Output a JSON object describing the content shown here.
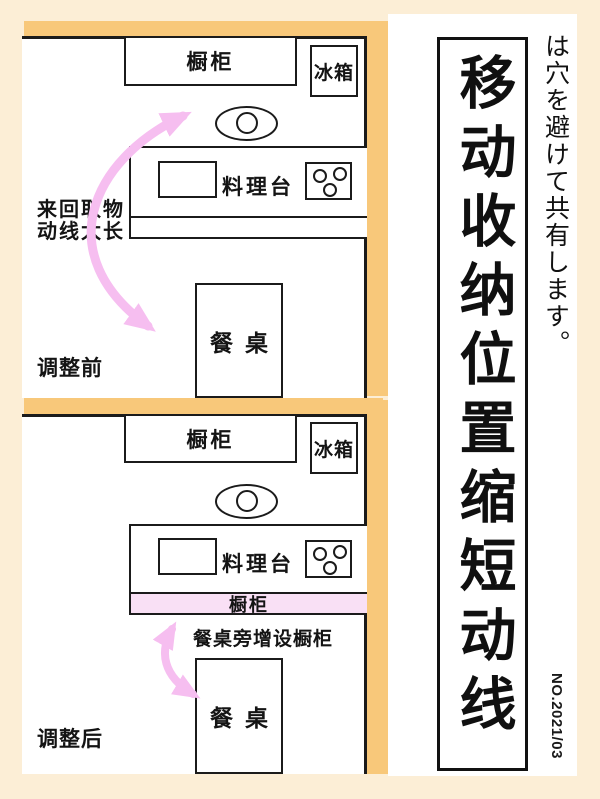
{
  "colors": {
    "background": "#FCEED6",
    "accent_orange": "#F8C87A",
    "arrow_pink": "#F6BEF0",
    "cupboard_pink": "#F9E0F5"
  },
  "before": {
    "section_label": "调整前",
    "flow_note_line1": "来回取物",
    "flow_note_line2": "动线太长",
    "cupboard_label": "橱柜",
    "fridge_label": "冰箱",
    "counter_label": "料理台",
    "table_label": "餐桌"
  },
  "after": {
    "section_label": "调整后",
    "note": "餐桌旁增设橱柜",
    "cupboard_label": "橱柜",
    "new_cupboard_label": "橱柜",
    "fridge_label": "冰箱",
    "counter_label": "料理台",
    "table_label": "餐桌"
  },
  "sidebar": {
    "title": "移动收纳位置缩短动线",
    "note_vertical": "は穴を避けて共有します。",
    "issue_number": "NO.2021/03"
  }
}
